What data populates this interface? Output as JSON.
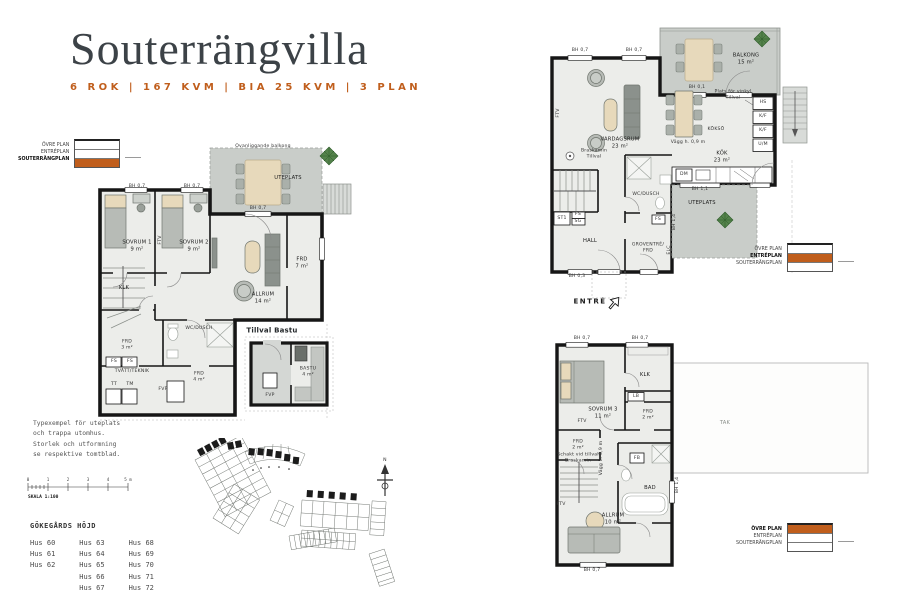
{
  "colors": {
    "accent": "#c05e1c",
    "wall": "#161616",
    "floor": "#ecedea",
    "outdoor": "#c9cdc9",
    "beige": "#e7d9bb",
    "gray": "#b7bbb6",
    "tree": "#54824b"
  },
  "header": {
    "title": "Souterrängvilla",
    "subtitle": "6 ROK  |  167 KVM  |  BIA 25 KVM  |  3 PLAN"
  },
  "legend": {
    "ovre": "ÖVRE PLAN",
    "entre": "ENTRÉPLAN",
    "sout": "SOUTERRÄNGPLAN"
  },
  "ps": {
    "ovanliggande": "Ovanliggande balkong",
    "uteplats": "UTEPLATS",
    "bh07": "BH 0,7",
    "sovrum1": "SOVRUM 1\n9 m²",
    "sovrum2": "SOVRUM 2\n9 m²",
    "ftv": "FTV",
    "klk": "KLK",
    "allrum": "ALLRUM\n14 m²",
    "frd7": "FRD\n7 m²",
    "wcdusch": "WC/DUSCH",
    "frd3": "FRD\n3 m²",
    "fs": "FS",
    "tvatt": "TVÄTT/TEKNIK",
    "tt": "TT",
    "tm": "TM",
    "fvp": "FVP",
    "frd4": "FRD\n4 m²"
  },
  "bastu": {
    "title": "Tillval Bastu",
    "room": "BASTU\n4 m²",
    "fvp": "FVP"
  },
  "pe": {
    "balkong": "BALKONG\n15 m²",
    "bh07": "BH 0,7",
    "bh01": "BH 0,1",
    "bh11": "BH 1,1",
    "bh03": "BH 0,3",
    "bh14": "BH 1,4",
    "vardagsrum": "VARDAGSRUM\n23 m²",
    "ftv": "FTV",
    "braskamin": "Braskamin\nTillval",
    "kokso": "KÖKSÖ",
    "vinkyl": "Plats för vinkyl\nTillval",
    "hs": "HS",
    "kf": "K/F",
    "um": "U/M",
    "vagg": "Vägg h. 0,9 m",
    "kok": "KÖK\n23 m²",
    "dm": "DM",
    "uteplats": "UTEPLATS",
    "wcdusch": "WC/DUSCH",
    "st1": "ST1",
    "fs": "FS",
    "sg": "SG",
    "hall": "HALL",
    "groventre": "GROVENTRÉ/\nFRD",
    "elc": "ELC",
    "entre": "ENTRÉ"
  },
  "po": {
    "bh07": "BH 0,7",
    "klk": "KLK",
    "lb": "LB",
    "sovrum3": "SOVRUM 3\n11 m²",
    "ftv": "FTV",
    "frd2": "FRD\n2 m²",
    "schakt": "Schakt vid tillval\nBraskamin",
    "vagg": "Vägg h. 0,9 m",
    "allrum": "ALLRUM\n10 m²",
    "bad": "BAD",
    "fb": "FB",
    "bh14": "BH 1,4",
    "tak": "TAK"
  },
  "footer": {
    "note": "Typexempel för uteplats\noch trappa utomhus.\nStorlek och utformning\nse respektive tomtblad.",
    "skala": "SKALA 1:100",
    "ticks": [
      "0",
      "1",
      "2",
      "3",
      "4",
      "5 m"
    ],
    "area": "GÖKEGÅRDS HÖJD",
    "hus": [
      [
        "Hus 60",
        "Hus 61",
        "Hus 62"
      ],
      [
        "Hus 63",
        "Hus 64",
        "Hus 65",
        "Hus 66",
        "Hus 67"
      ],
      [
        "Hus 68",
        "Hus 69",
        "Hus 70",
        "Hus 71",
        "Hus 72"
      ]
    ]
  },
  "misc": {
    "north": "N"
  }
}
